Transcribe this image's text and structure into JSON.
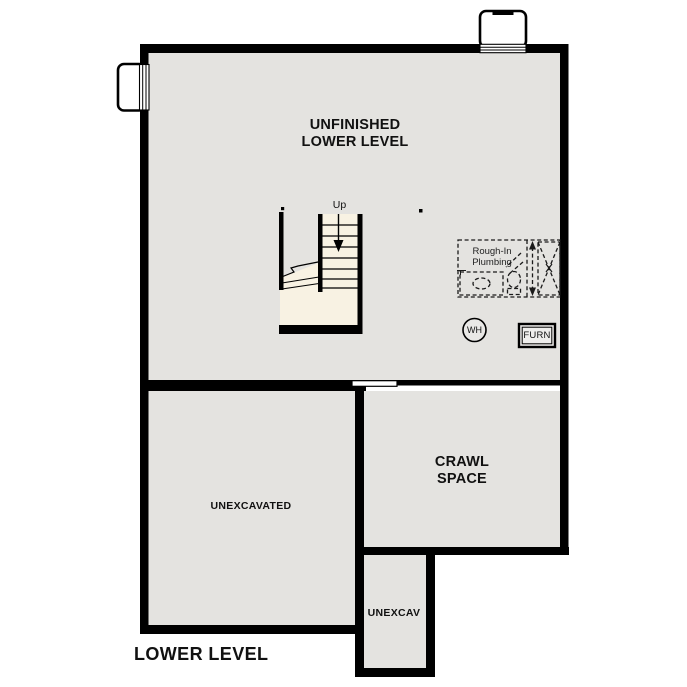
{
  "title": "LOWER LEVEL",
  "colors": {
    "wall": "#000000",
    "floor": "#e4e3e0",
    "stair_fill": "#f8f2e3",
    "background": "#ffffff",
    "text": "#111111"
  },
  "rooms": {
    "main": {
      "label": "UNFINISHED LOWER LEVEL"
    },
    "crawl": {
      "label": "CRAWL SPACE"
    },
    "unexcavated": {
      "label": "UNEXCAVATED"
    },
    "unexcav": {
      "label": "UNEXCAV"
    }
  },
  "stairs": {
    "direction_label": "Up"
  },
  "plumbing": {
    "label": "Rough-In Plumbing"
  },
  "equipment": {
    "water_heater": "WH",
    "furnace": "FURN"
  }
}
